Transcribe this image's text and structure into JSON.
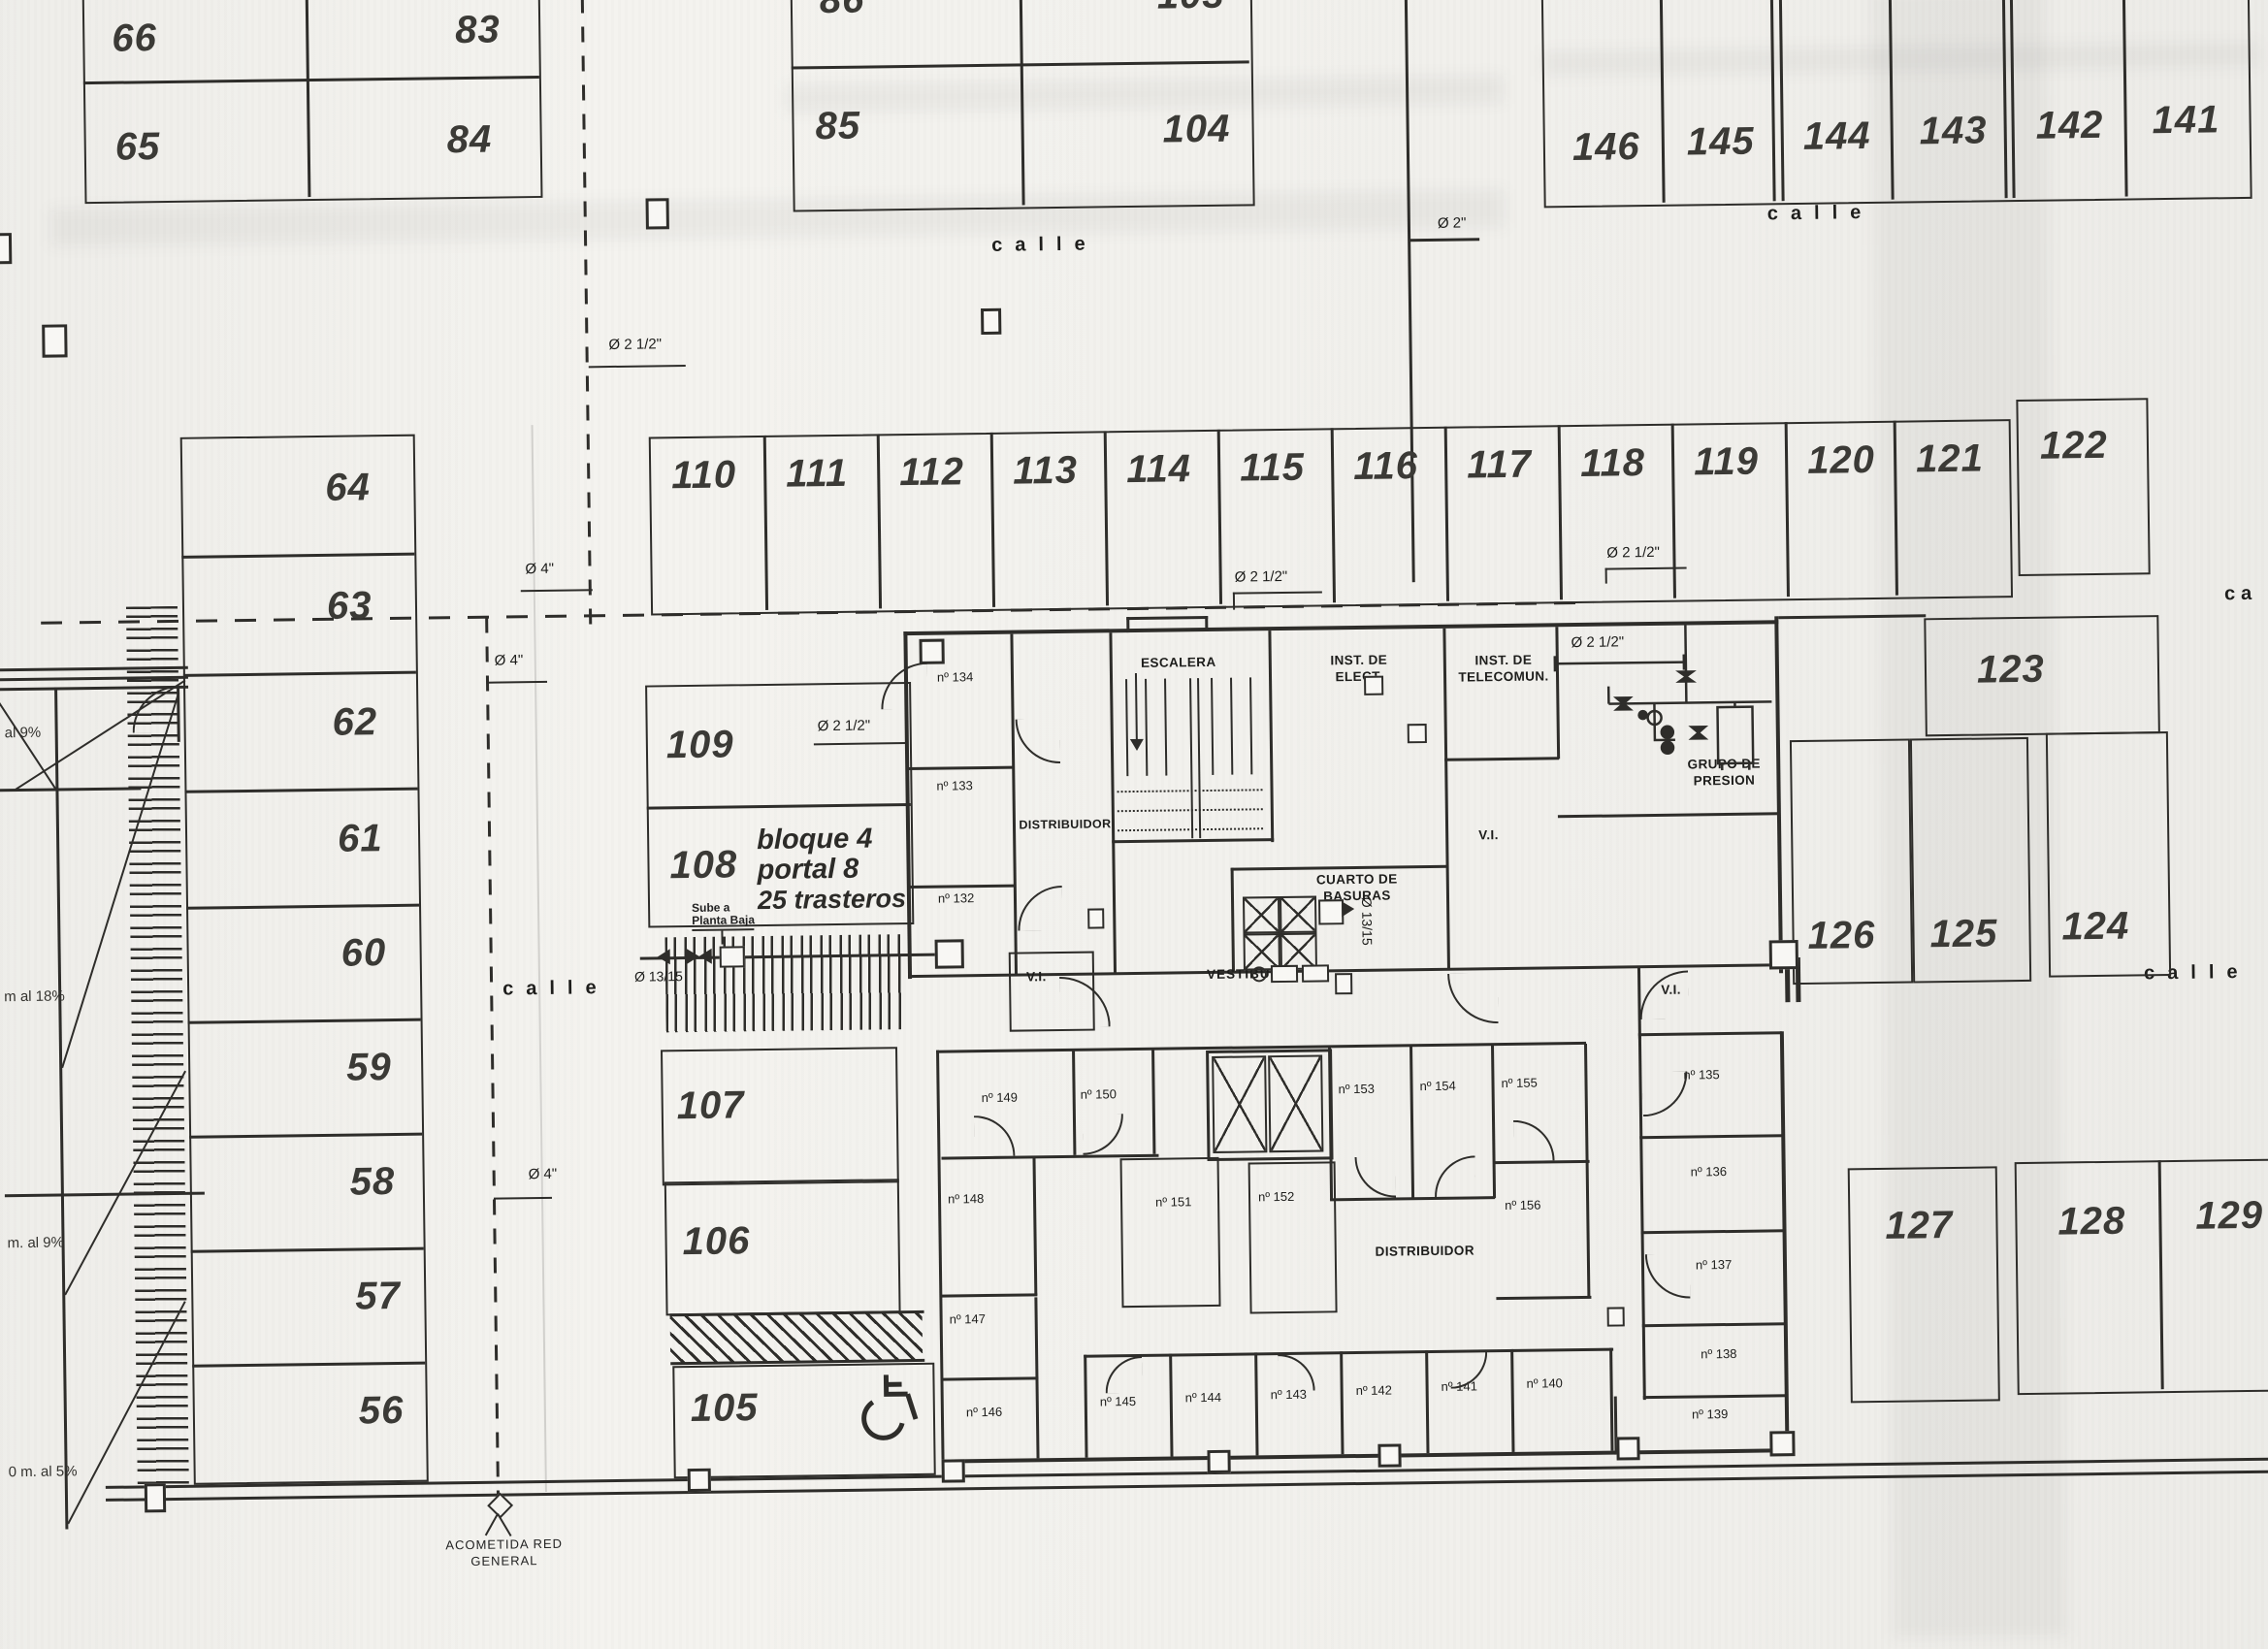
{
  "street": {
    "label": "calle",
    "label_cut": "ca"
  },
  "parking": {
    "56": "56",
    "57": "57",
    "58": "58",
    "59": "59",
    "60": "60",
    "61": "61",
    "62": "62",
    "63": "63",
    "64": "64",
    "65": "65",
    "66": "66",
    "83": "83",
    "84": "84",
    "85": "85",
    "86": "86",
    "103": "103",
    "104": "104",
    "105": "105",
    "106": "106",
    "107": "107",
    "108": "108",
    "109": "109",
    "110": "110",
    "111": "111",
    "112": "112",
    "113": "113",
    "114": "114",
    "115": "115",
    "116": "116",
    "117": "117",
    "118": "118",
    "119": "119",
    "120": "120",
    "121": "121",
    "122": "122",
    "123": "123",
    "124": "124",
    "125": "125",
    "126": "126",
    "127": "127",
    "128": "128",
    "129": "129",
    "141": "141",
    "142": "142",
    "143": "143",
    "144": "144",
    "145": "145",
    "146": "146"
  },
  "trastero": {
    "132": "nº 132",
    "133": "nº 133",
    "134": "nº 134",
    "135": "nº 135",
    "136": "nº 136",
    "137": "nº 137",
    "138": "nº 138",
    "139": "nº 139",
    "140": "nº 140",
    "141": "nº 141",
    "142": "nº 142",
    "143": "nº 143",
    "144": "nº 144",
    "145": "nº 145",
    "146": "nº 146",
    "147": "nº 147",
    "148": "nº 148",
    "149": "nº 149",
    "150": "nº 150",
    "151": "nº 151",
    "152": "nº 152",
    "153": "nº 153",
    "154": "nº 154",
    "155": "nº 155",
    "156": "nº 156"
  },
  "room": {
    "distribuidor": "DISTRIBUIDOR",
    "escalera": "ESCALERA",
    "inst_elect": "INST. DE ELECT.",
    "inst_telecom": "INST. DE TELECOMUN.",
    "cuarto_basuras": "CUARTO DE BASURAS",
    "grupo_presion": "GRUPO DE PRESION",
    "vestibulo": "VESTIBULO",
    "vi": "V.I."
  },
  "note": {
    "bloque": "bloque 4",
    "portal": "portal 8",
    "trasteros": "25 trasteros",
    "sube1": "Sube a",
    "sube2": "Planta Baja",
    "acometida1": "ACOMETIDA RED",
    "acometida2": "GENERAL"
  },
  "pipe": {
    "d2": "Ø 2\"",
    "d4": "Ø 4\"",
    "d212": "Ø 2 1/2\"",
    "d1315": "Ø 13/15"
  },
  "slope": {
    "s9a": "al 9%",
    "s18": "m al 18%",
    "s9b": "m. al 9%",
    "s5": "0 m. al 5%"
  }
}
